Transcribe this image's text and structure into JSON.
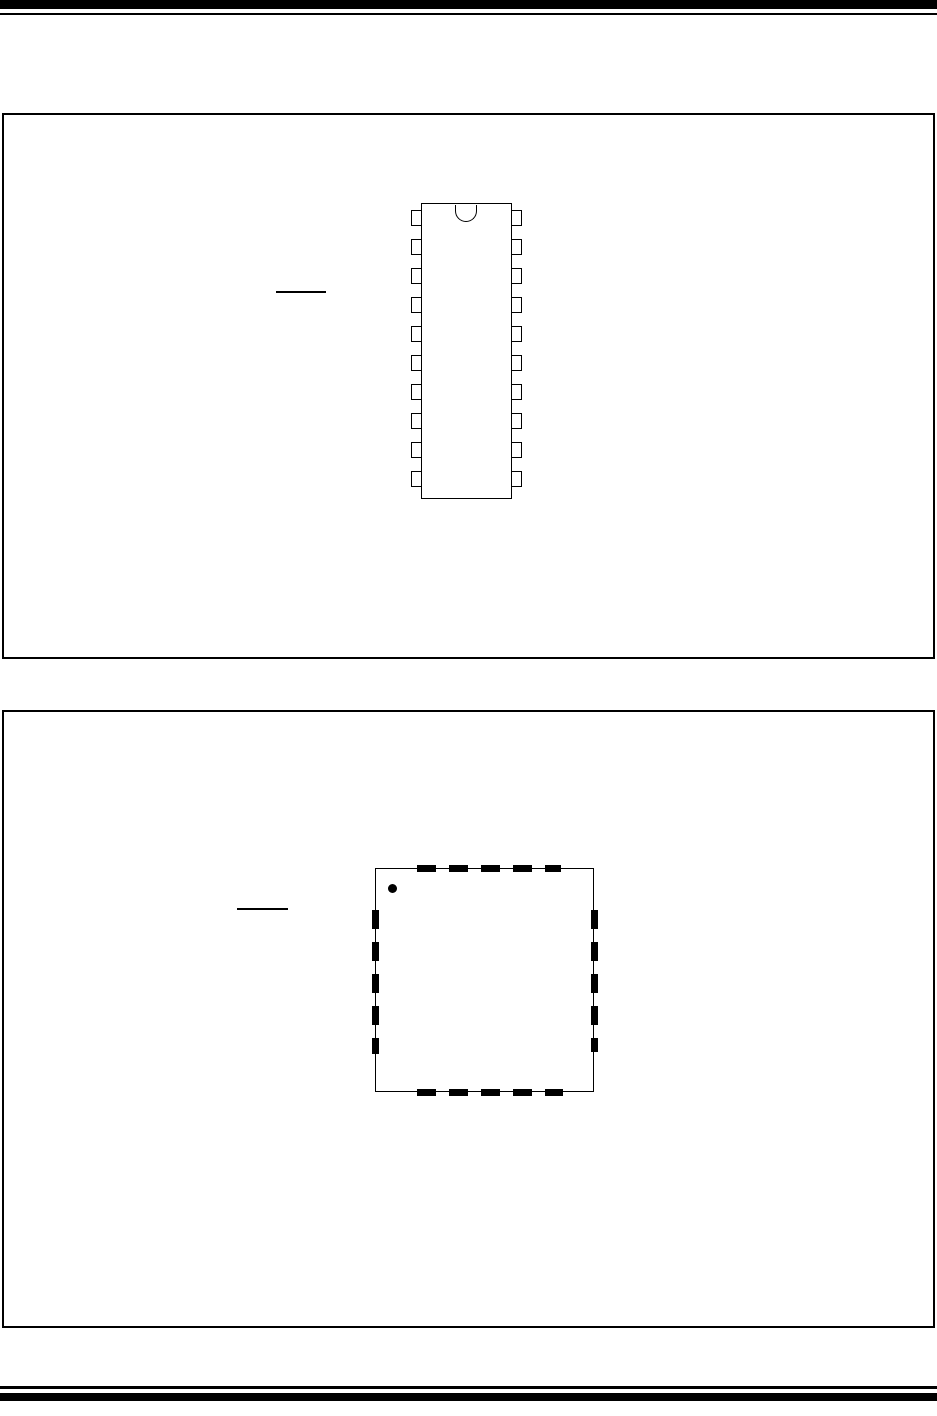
{
  "page": {
    "kind": "datasheet-package-outline-page",
    "background": "#ffffff",
    "ink": "#000000",
    "width": 937,
    "height": 1416,
    "visible_text": ""
  },
  "header": {
    "rules": [
      {
        "x": 0,
        "y": 0,
        "width": 937,
        "height": 9
      },
      {
        "x": 0,
        "y": 12.5,
        "width": 937,
        "height": 2.5
      }
    ]
  },
  "footer": {
    "rules": [
      {
        "x": 0,
        "y": 1386,
        "width": 937,
        "height": 2.5
      },
      {
        "x": 0,
        "y": 1393,
        "width": 937,
        "height": 8
      }
    ]
  },
  "figures": [
    {
      "id": "figure-1",
      "description": "boxed figure containing a 20-pin dual-in-line package outline drawing, pin-1 notch at top, no text rendered",
      "frame": {
        "x": 2,
        "y": 113,
        "width": 933,
        "height": 546
      },
      "overline": {
        "x": 276,
        "y": 291,
        "width": 50,
        "height": 1.5
      },
      "package": {
        "type": "dual-in-line",
        "pin_count": 20,
        "body": {
          "x": 421,
          "y": 203,
          "width": 91,
          "height": 296
        },
        "notch": {
          "x": 455,
          "y": 204.5,
          "width": 22,
          "height": 17
        },
        "pins": {
          "per_side": 10,
          "width": 11,
          "height": 16,
          "first_y": 210,
          "pitch": 29
        }
      }
    },
    {
      "id": "figure-2",
      "description": "boxed figure containing a QFN-style square package outline with dashed edge pads and a filled pin-1 index dot, no text rendered",
      "frame": {
        "x": 2,
        "y": 710,
        "width": 933,
        "height": 618
      },
      "overline": {
        "x": 237,
        "y": 908,
        "width": 51,
        "height": 1.5
      },
      "package": {
        "type": "qfn-square",
        "body": {
          "x": 375,
          "y": 868,
          "width": 219,
          "height": 224
        },
        "pin1_dot": {
          "x": 388,
          "y": 884,
          "width": 9,
          "height": 9
        },
        "pads_per_side": 5,
        "dash": {
          "length": 19,
          "gap": 13
        },
        "pads": {
          "top": {
            "x": 417,
            "y": 864.5,
            "width": 144,
            "height": 7,
            "axis": "h"
          },
          "bottom": {
            "x": 417,
            "y": 1088.5,
            "width": 146,
            "height": 7,
            "axis": "h"
          },
          "left": {
            "x": 371.5,
            "y": 910,
            "width": 7,
            "height": 144,
            "axis": "v"
          },
          "right": {
            "x": 590.5,
            "y": 910,
            "width": 7,
            "height": 142,
            "axis": "v"
          }
        }
      }
    }
  ]
}
